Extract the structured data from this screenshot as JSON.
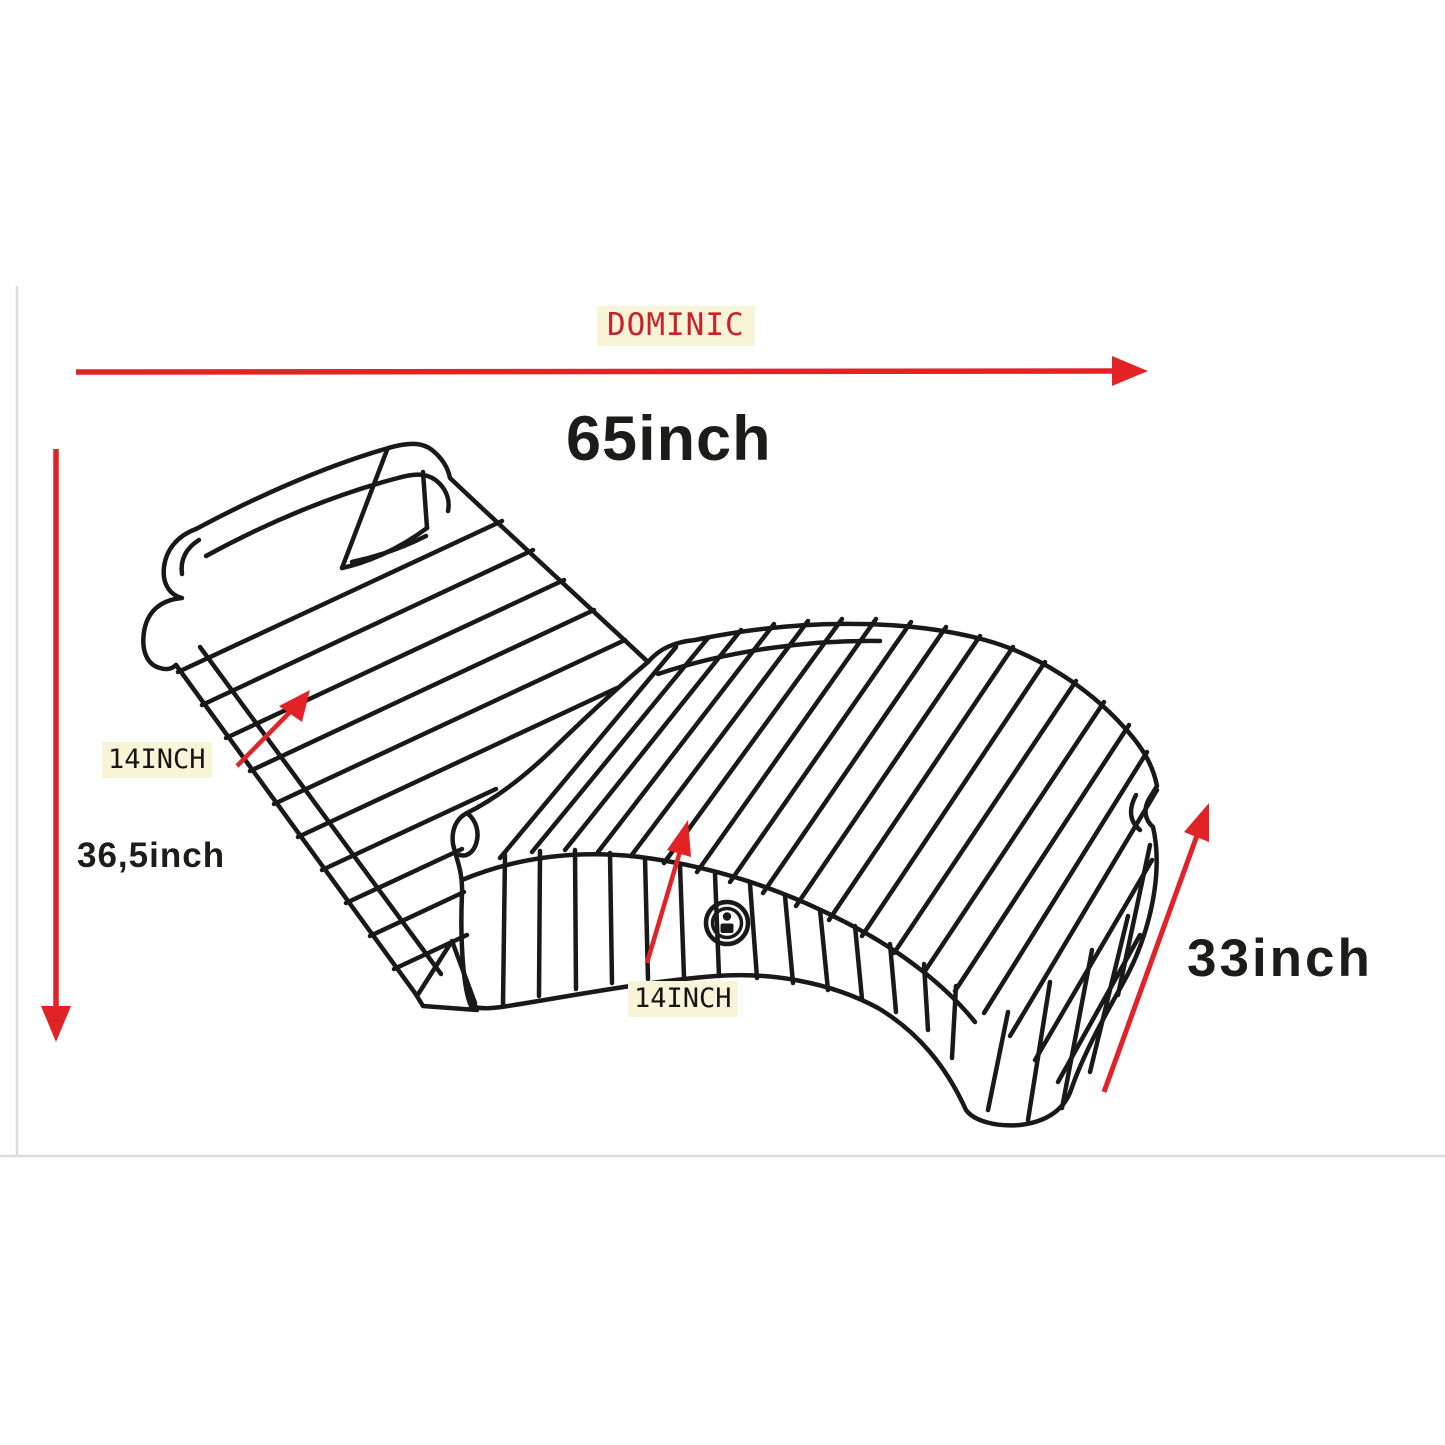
{
  "diagram": {
    "brand": "DOMINIC",
    "measurements": {
      "overall_length": "65inch",
      "overall_height": "36,5inch",
      "side_depth": "33inch",
      "backrest_width": "14INCH",
      "seat_width": "14INCH"
    },
    "icons": {
      "control_button": "round-control-button"
    },
    "colors": {
      "arrow_red": "#e12227",
      "brand_red": "#c92128",
      "highlight_yellow": "#f8f4d8",
      "ink_black": "#1c1c1a",
      "line_black": "#191919",
      "border_gray": "#dcdcdc"
    }
  }
}
